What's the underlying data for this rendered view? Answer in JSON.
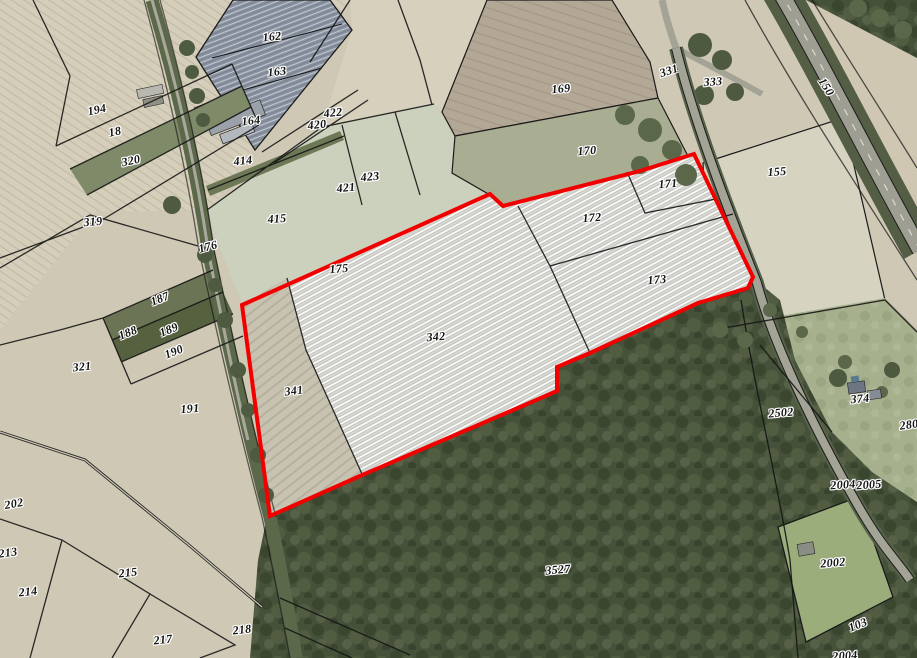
{
  "map": {
    "kind": "cadastral-aerial-map",
    "colors": {
      "selection_outline": "#f20000",
      "field_tan": "#d2cbb8",
      "field_green": "#ccd1bd",
      "forest": "#46513a",
      "greenhouse": "#8a92a0",
      "road": "#a3a396",
      "hatch_bg": "#c9cac3",
      "hatch_line": "#ffffff",
      "boundary_line": "#111111"
    },
    "parcel_labels": [
      {
        "text": "162",
        "x": 272,
        "y": 37,
        "rot": -6
      },
      {
        "text": "163",
        "x": 277,
        "y": 72,
        "rot": -6
      },
      {
        "text": "164",
        "x": 251,
        "y": 121,
        "rot": -6
      },
      {
        "text": "194",
        "x": 97,
        "y": 110,
        "rot": -12
      },
      {
        "text": "18",
        "x": 115,
        "y": 132,
        "rot": -12
      },
      {
        "text": "320",
        "x": 131,
        "y": 161,
        "rot": -12
      },
      {
        "text": "414",
        "x": 243,
        "y": 161,
        "rot": -6
      },
      {
        "text": "422",
        "x": 333,
        "y": 113,
        "rot": -6
      },
      {
        "text": "420",
        "x": 317,
        "y": 125,
        "rot": -6
      },
      {
        "text": "423",
        "x": 370,
        "y": 177,
        "rot": -6
      },
      {
        "text": "421",
        "x": 346,
        "y": 188,
        "rot": -6
      },
      {
        "text": "415",
        "x": 277,
        "y": 219,
        "rot": -4
      },
      {
        "text": "169",
        "x": 561,
        "y": 89,
        "rot": -5
      },
      {
        "text": "331",
        "x": 669,
        "y": 71,
        "rot": -18
      },
      {
        "text": "333",
        "x": 713,
        "y": 82,
        "rot": -4
      },
      {
        "text": "150",
        "x": 826,
        "y": 87,
        "rot": 58
      },
      {
        "text": "170",
        "x": 587,
        "y": 151,
        "rot": -5
      },
      {
        "text": "155",
        "x": 777,
        "y": 172,
        "rot": -4
      },
      {
        "text": "171",
        "x": 668,
        "y": 184,
        "rot": -5
      },
      {
        "text": "172",
        "x": 592,
        "y": 218,
        "rot": -5
      },
      {
        "text": "173",
        "x": 657,
        "y": 280,
        "rot": -5
      },
      {
        "text": "175",
        "x": 339,
        "y": 269,
        "rot": -5
      },
      {
        "text": "342",
        "x": 436,
        "y": 337,
        "rot": -5
      },
      {
        "text": "341",
        "x": 294,
        "y": 391,
        "rot": -7
      },
      {
        "text": "176",
        "x": 208,
        "y": 247,
        "rot": -15
      },
      {
        "text": "319",
        "x": 93,
        "y": 222,
        "rot": -5
      },
      {
        "text": "187",
        "x": 160,
        "y": 299,
        "rot": -22
      },
      {
        "text": "188",
        "x": 128,
        "y": 333,
        "rot": -22
      },
      {
        "text": "189",
        "x": 169,
        "y": 330,
        "rot": -22
      },
      {
        "text": "190",
        "x": 174,
        "y": 352,
        "rot": -22
      },
      {
        "text": "321",
        "x": 82,
        "y": 367,
        "rot": -6
      },
      {
        "text": "191",
        "x": 190,
        "y": 409,
        "rot": -5
      },
      {
        "text": "202",
        "x": 14,
        "y": 504,
        "rot": -10
      },
      {
        "text": "213",
        "x": 8,
        "y": 553,
        "rot": -8
      },
      {
        "text": "214",
        "x": 28,
        "y": 592,
        "rot": -6
      },
      {
        "text": "215",
        "x": 128,
        "y": 573,
        "rot": -6
      },
      {
        "text": "217",
        "x": 163,
        "y": 640,
        "rot": -6
      },
      {
        "text": "218",
        "x": 242,
        "y": 630,
        "rot": -6
      },
      {
        "text": "3527",
        "x": 558,
        "y": 570,
        "rot": -5
      },
      {
        "text": "2502",
        "x": 781,
        "y": 413,
        "rot": -5
      },
      {
        "text": "374",
        "x": 860,
        "y": 399,
        "rot": -5
      },
      {
        "text": "280",
        "x": 909,
        "y": 425,
        "rot": -8
      },
      {
        "text": "2004",
        "x": 843,
        "y": 485,
        "rot": -4
      },
      {
        "text": "2005",
        "x": 869,
        "y": 485,
        "rot": -4
      },
      {
        "text": "2002",
        "x": 833,
        "y": 563,
        "rot": -5
      },
      {
        "text": "103",
        "x": 858,
        "y": 625,
        "rot": -22
      },
      {
        "text": "2004",
        "x": 845,
        "y": 656,
        "rot": -4
      }
    ]
  }
}
